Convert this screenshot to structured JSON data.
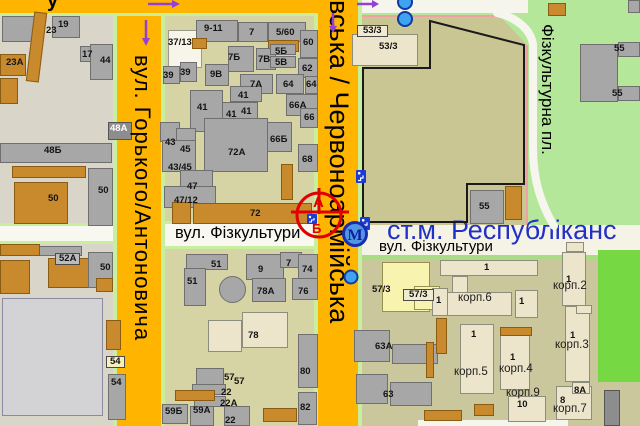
{
  "top_street_partial": "у",
  "streets": {
    "gorkogo": "вул. Горького/Антоновича",
    "chervonoarmiyska": "івська / Червоноармійська",
    "fizkultury_left": "вул. Фізкультури",
    "fizkultury_right": "вул. Фізкультури",
    "fizkulturna_square": "Фізкультурна пл."
  },
  "metro_station": {
    "label": "ст.м. Республіканс",
    "symbol": "М"
  },
  "marker": {
    "side_a": "А",
    "side_b": "Б"
  },
  "colors": {
    "street_orange": "#ffb400",
    "street_edge_green": "#c8ef9e",
    "stadium_khaki": "#c9c694",
    "park_green": "#b5e79a",
    "bright_green": "#76d943",
    "station_blue": "#2230c8",
    "marker_red": "#e00000",
    "arrow_purple": "#9340d5"
  },
  "building_labels": [
    {
      "t": "23",
      "x": 46,
      "y": 26
    },
    {
      "t": "19",
      "x": 58,
      "y": 20
    },
    {
      "t": "23А",
      "x": 6,
      "y": 58
    },
    {
      "t": "17",
      "x": 82,
      "y": 50
    },
    {
      "t": "44",
      "x": 100,
      "y": 56
    },
    {
      "t": "48А",
      "x": 110,
      "y": 124,
      "cls": "white"
    },
    {
      "t": "48Б",
      "x": 44,
      "y": 146
    },
    {
      "t": "50",
      "x": 48,
      "y": 194
    },
    {
      "t": "50",
      "x": 98,
      "y": 186
    },
    {
      "t": "52А",
      "x": 55,
      "y": 253,
      "cls": "box-gray"
    },
    {
      "t": "50",
      "x": 100,
      "y": 263
    },
    {
      "t": "54",
      "x": 106,
      "y": 356,
      "cls": "box-yellow"
    },
    {
      "t": "54",
      "x": 111,
      "y": 378
    },
    {
      "t": "37/13",
      "x": 168,
      "y": 38
    },
    {
      "t": "9-11",
      "x": 204,
      "y": 24
    },
    {
      "t": "7",
      "x": 249,
      "y": 28
    },
    {
      "t": "5/60",
      "x": 276,
      "y": 28
    },
    {
      "t": "60",
      "x": 303,
      "y": 38
    },
    {
      "t": "7Б",
      "x": 228,
      "y": 53
    },
    {
      "t": "7В",
      "x": 258,
      "y": 55
    },
    {
      "t": "5Б",
      "x": 275,
      "y": 47
    },
    {
      "t": "5В",
      "x": 275,
      "y": 58
    },
    {
      "t": "62",
      "x": 302,
      "y": 64
    },
    {
      "t": "39",
      "x": 163,
      "y": 71
    },
    {
      "t": "39",
      "x": 180,
      "y": 68
    },
    {
      "t": "9В",
      "x": 210,
      "y": 70
    },
    {
      "t": "7А",
      "x": 250,
      "y": 80
    },
    {
      "t": "64",
      "x": 283,
      "y": 80
    },
    {
      "t": "64",
      "x": 306,
      "y": 80
    },
    {
      "t": "41",
      "x": 238,
      "y": 91
    },
    {
      "t": "41",
      "x": 197,
      "y": 103
    },
    {
      "t": "41",
      "x": 226,
      "y": 110
    },
    {
      "t": "41",
      "x": 241,
      "y": 107
    },
    {
      "t": "66А",
      "x": 289,
      "y": 101
    },
    {
      "t": "66",
      "x": 304,
      "y": 113
    },
    {
      "t": "43",
      "x": 165,
      "y": 138
    },
    {
      "t": "45",
      "x": 180,
      "y": 145
    },
    {
      "t": "43/45",
      "x": 168,
      "y": 163
    },
    {
      "t": "66Б",
      "x": 270,
      "y": 135
    },
    {
      "t": "72А",
      "x": 228,
      "y": 148
    },
    {
      "t": "68",
      "x": 302,
      "y": 155
    },
    {
      "t": "47",
      "x": 187,
      "y": 182
    },
    {
      "t": "47/12",
      "x": 174,
      "y": 196
    },
    {
      "t": "72",
      "x": 250,
      "y": 209
    },
    {
      "t": "51",
      "x": 211,
      "y": 260
    },
    {
      "t": "51",
      "x": 187,
      "y": 277
    },
    {
      "t": "9",
      "x": 258,
      "y": 265
    },
    {
      "t": "7",
      "x": 286,
      "y": 259
    },
    {
      "t": "74",
      "x": 302,
      "y": 265
    },
    {
      "t": "78А",
      "x": 257,
      "y": 287
    },
    {
      "t": "76",
      "x": 298,
      "y": 287
    },
    {
      "t": "78",
      "x": 248,
      "y": 331
    },
    {
      "t": "80",
      "x": 300,
      "y": 367
    },
    {
      "t": "57",
      "x": 224,
      "y": 373
    },
    {
      "t": "57",
      "x": 234,
      "y": 377
    },
    {
      "t": "22",
      "x": 221,
      "y": 388
    },
    {
      "t": "22А",
      "x": 220,
      "y": 399
    },
    {
      "t": "22",
      "x": 225,
      "y": 416
    },
    {
      "t": "59Б",
      "x": 165,
      "y": 407
    },
    {
      "t": "59А",
      "x": 193,
      "y": 406
    },
    {
      "t": "82",
      "x": 300,
      "y": 403
    },
    {
      "t": "53/3",
      "x": 357,
      "y": 25,
      "cls": "box-cream"
    },
    {
      "t": "53/3",
      "x": 379,
      "y": 42
    },
    {
      "t": "55",
      "x": 479,
      "y": 202
    },
    {
      "t": "55",
      "x": 614,
      "y": 44
    },
    {
      "t": "55",
      "x": 612,
      "y": 89
    },
    {
      "t": "57/3",
      "x": 372,
      "y": 285
    },
    {
      "t": "57/3",
      "x": 403,
      "y": 289,
      "cls": "box-cream"
    },
    {
      "t": "1",
      "x": 484,
      "y": 263
    },
    {
      "t": "1",
      "x": 436,
      "y": 296
    },
    {
      "t": "корп.6",
      "x": 458,
      "y": 293,
      "cls": "corp"
    },
    {
      "t": "1",
      "x": 519,
      "y": 297
    },
    {
      "t": "1",
      "x": 566,
      "y": 275
    },
    {
      "t": "корп.2",
      "x": 553,
      "y": 281,
      "cls": "corp"
    },
    {
      "t": "1",
      "x": 570,
      "y": 331
    },
    {
      "t": "корп.3",
      "x": 555,
      "y": 340,
      "cls": "corp"
    },
    {
      "t": "63А",
      "x": 375,
      "y": 342
    },
    {
      "t": "1",
      "x": 471,
      "y": 330
    },
    {
      "t": "корп.5",
      "x": 454,
      "y": 367,
      "cls": "corp"
    },
    {
      "t": "1",
      "x": 510,
      "y": 353
    },
    {
      "t": "корп.4",
      "x": 499,
      "y": 364,
      "cls": "corp"
    },
    {
      "t": "корп.9",
      "x": 506,
      "y": 388,
      "cls": "corp"
    },
    {
      "t": "10",
      "x": 517,
      "y": 400
    },
    {
      "t": "8",
      "x": 560,
      "y": 396
    },
    {
      "t": "8А",
      "x": 574,
      "y": 386
    },
    {
      "t": "корп.7",
      "x": 553,
      "y": 404,
      "cls": "corp"
    },
    {
      "t": "63",
      "x": 383,
      "y": 390
    }
  ]
}
